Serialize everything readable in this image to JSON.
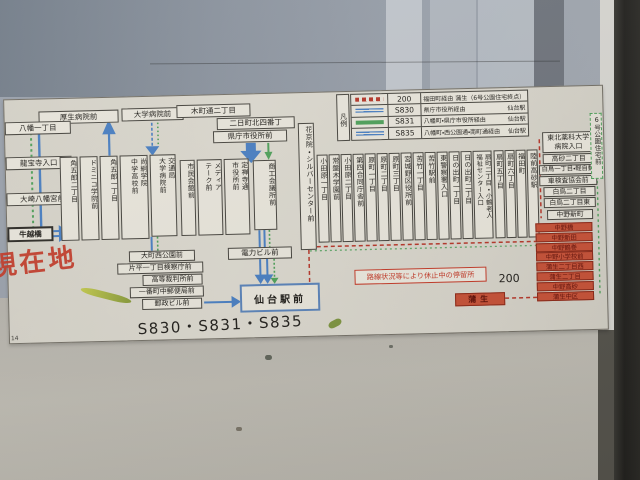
{
  "sign": {
    "legend": {
      "title": "凡例",
      "rows": [
        {
          "route": "200",
          "via": "福田町経由",
          "dest": "蒲生（6号公園住宅終点）"
        },
        {
          "route": "S830",
          "via": "県庁市役所経由",
          "dest": "仙台駅"
        },
        {
          "route": "S831",
          "via": "八幡町・県庁市役所経由",
          "dest": "仙台駅"
        },
        {
          "route": "S835",
          "via": "八幡町・西公園通・南町通経由",
          "dest": "仙台駅"
        }
      ]
    },
    "current_location": "現在地",
    "current_stop": "牛越橋",
    "routes_caption": "S830・S831・S835",
    "route200_caption": "200",
    "suspended_note": "路線状況等により休止中の停留所",
    "corner_mark": "14",
    "colors": {
      "route_blue": "#4a7fc1",
      "route_green": "#4fa05a",
      "route_red_dashed": "#b5372a",
      "suspended_stop_bg": "#c65238",
      "paper": "#d9d6cc"
    },
    "stops": {
      "top": [
        "厚生病院前",
        "大学病院前",
        "木町通二丁目",
        "二日町北四番丁",
        "県庁市役所前"
      ],
      "west": [
        "八幡一丁目",
        "龍宝寺入口",
        "大崎八幡宮前"
      ],
      "west_cols": [
        "角五郎二丁目",
        "ドミニコ学院前",
        "角五郎一丁目"
      ],
      "shokei": {
        "l1": "尚絅学院",
        "l2": "中学高校前"
      },
      "kotsukyoku": {
        "l1": "交通局",
        "l2": "大学病院前"
      },
      "shimin": "市民会館前",
      "mediatheque": {
        "l1": "メディア",
        "l2": "テーク前"
      },
      "jozenji": {
        "l1": "定禅寺通",
        "l2": "市役所前"
      },
      "shoko": "商工会議所前",
      "kakyoin": "花京院・シルバーセンター前",
      "mid_cols": [
        "小田原一丁目",
        "常盤木学園前",
        "小田原二丁目",
        "第四合同庁舎前",
        "原町一丁目",
        "原町二丁目",
        "原町三丁目",
        "宮城野区役所前",
        "苦竹一丁目",
        "苦竹駅前",
        "東警察署入口",
        "日の出町一丁目",
        "日の出町二丁目"
      ],
      "ogimachi_wide": {
        "l1": "扇町二丁目・小鶴老人",
        "l2": "福祉センター入口"
      },
      "mid_cols2": [
        "扇町五丁目",
        "扇町六丁目",
        "福田町",
        "陸前高砂駅"
      ],
      "east_first": {
        "l1": "東北薬科大学",
        "l2": "病院入口"
      },
      "east": [
        "高砂二丁目",
        "白鳥一丁目・軽自動",
        "車検査協会前",
        "白鳥二丁目",
        "白鳥二丁目東",
        "中野新町"
      ],
      "suspended": [
        "中野橋",
        "中野新田",
        "中野鶴巻",
        "中野小学校前",
        "蒲生二丁目西",
        "蒲生二丁目",
        "中野高砂",
        "蒲生中区"
      ],
      "gamo_terminal": "蒲生",
      "rokugo_terminal": "6号公園住宅前",
      "south": [
        "大町西公園前",
        "片平一丁目検察庁前",
        "高等裁判所前",
        "一番町中郵便局前",
        "郵政ビル前"
      ],
      "denryoku": "電力ビル前",
      "sendai_station": "仙台駅前"
    }
  }
}
